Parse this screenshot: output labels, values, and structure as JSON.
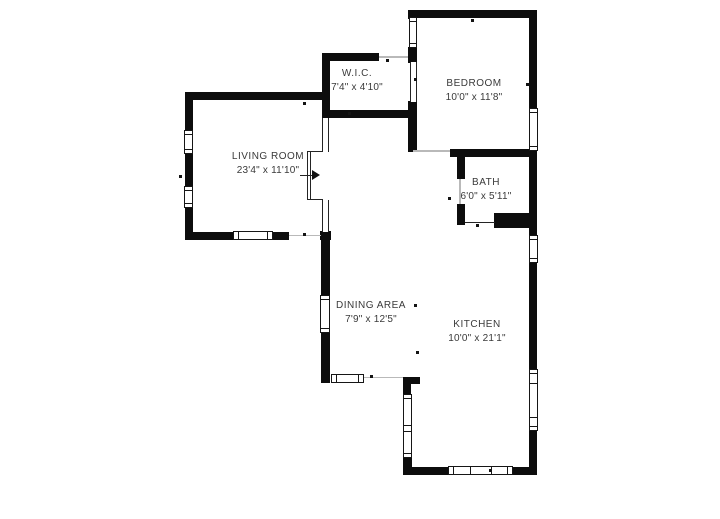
{
  "plan": {
    "type": "floor-plan",
    "background_color": "#ffffff",
    "wall_color": "#0d0d0d",
    "label_color": "#3a3a3a"
  },
  "rooms": [
    {
      "name": "W.I.C.",
      "dimensions": "7'4\" x 4'10\""
    },
    {
      "name": "BEDROOM",
      "dimensions": "10'0\" x 11'8\""
    },
    {
      "name": "LIVING ROOM",
      "dimensions": "23'4\" x 11'10\""
    },
    {
      "name": "BATH",
      "dimensions": "6'0\" x 5'11\""
    },
    {
      "name": "DINING AREA",
      "dimensions": "7'9\" x 12'5\""
    },
    {
      "name": "KITCHEN",
      "dimensions": "10'0\" x 21'1\""
    }
  ]
}
